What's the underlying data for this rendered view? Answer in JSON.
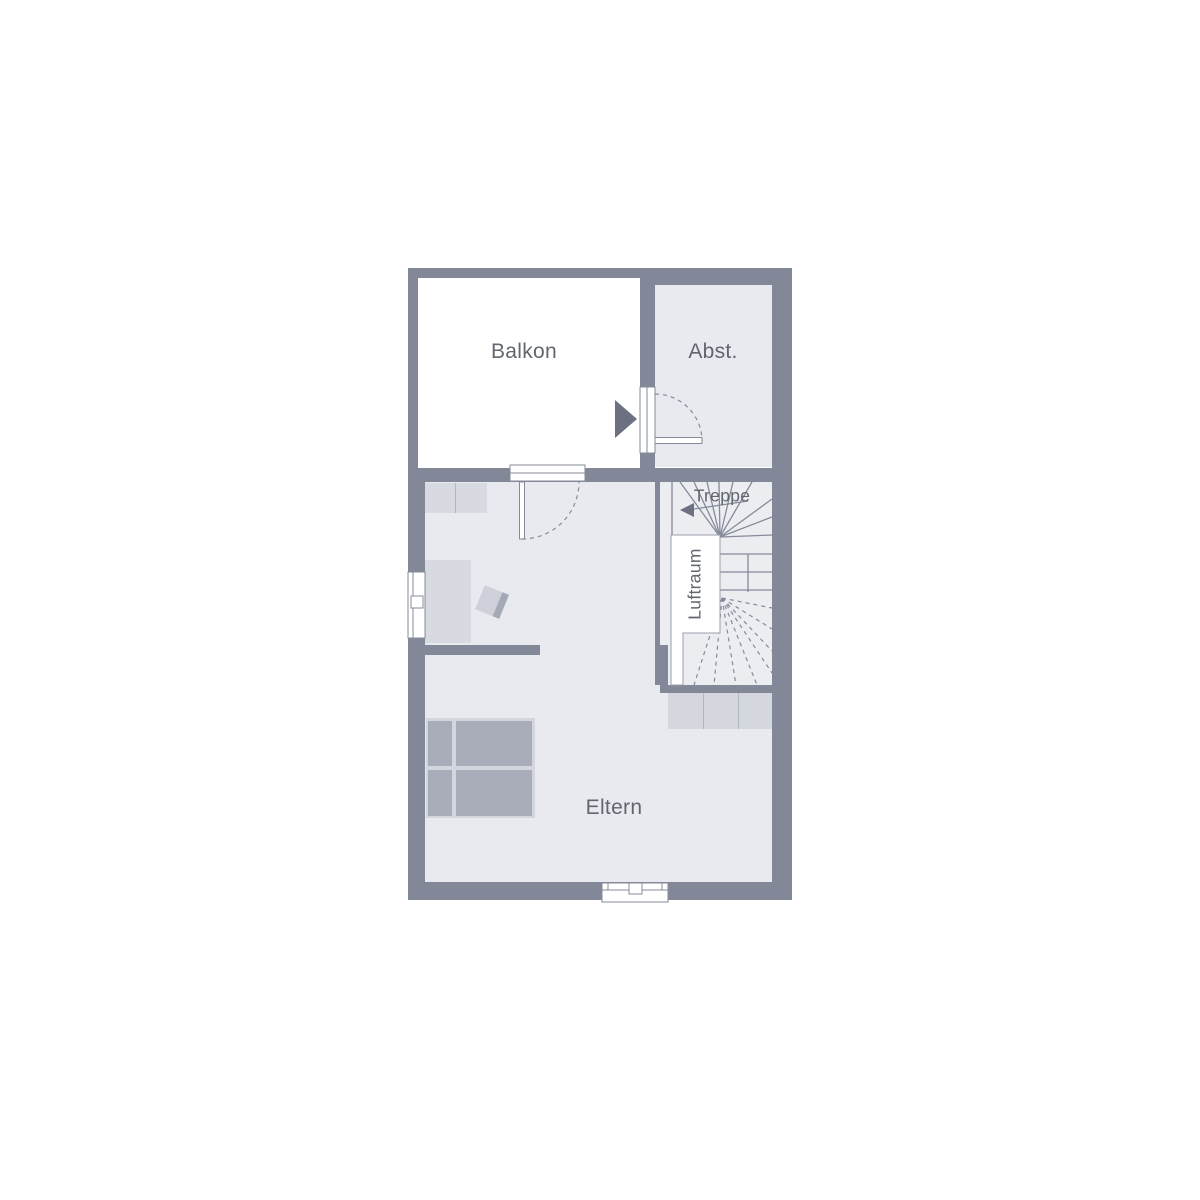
{
  "labels": {
    "balkon": "Balkon",
    "abst": "Abst.",
    "treppe": "Treppe",
    "luftraum": "Luftraum",
    "eltern": "Eltern"
  },
  "colors": {
    "wall": "#828897",
    "room_fill": "#e8eaef",
    "stair_fill": "#ebedf1",
    "balcony_fill": "#ffffff",
    "furniture_light": "#d8dae2",
    "furniture_mid": "#ced1da",
    "furniture_dark": "#a9adb9",
    "symbol_line": "#858b9a",
    "entrance_arrow": "#6b7181",
    "text": "#61666f"
  }
}
